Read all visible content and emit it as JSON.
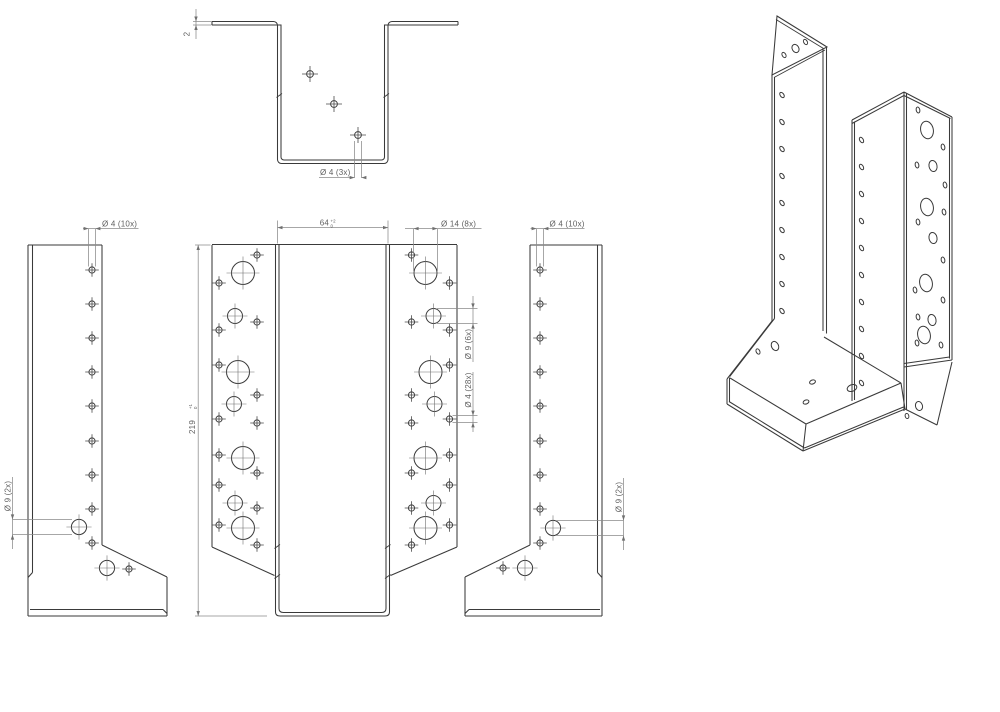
{
  "title": "Joist hanger technical drawing",
  "colors": {
    "outline": "#3a3a3a",
    "dimension": "#8a8a8a",
    "centerline": "#707070",
    "text": "#5f5f5f",
    "background": "#ffffff"
  },
  "labels": {
    "thickness": "2",
    "seat_holes": "Ø 4 (3x)",
    "flange_holes_left": "Ø 4 (10x)",
    "flange_big_left": "Ø 9 (2x)",
    "width": "64",
    "width_tol_upper": "+2",
    "width_tol_lower": "0",
    "height": "219",
    "height_tol_upper": "+1",
    "height_tol_lower": "0",
    "wing_big_holes": "Ø 14 (8x)",
    "wing_med_holes": "Ø 9 (6x)",
    "wing_small_holes": "Ø 4 (28x)",
    "flange_holes_right": "Ø 4 (10x)",
    "flange_big_right": "Ø 9 (2x)"
  }
}
